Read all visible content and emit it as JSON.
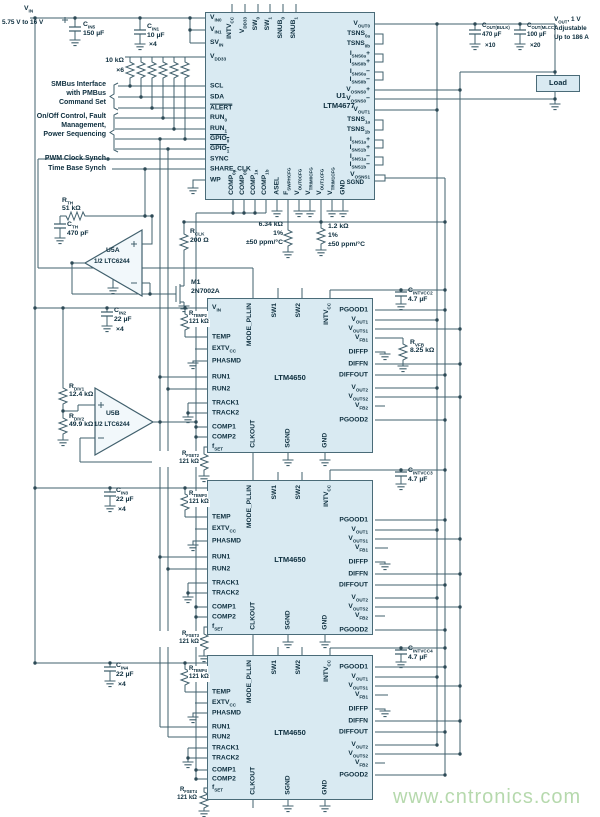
{
  "supply": {
    "vin": "V~IN~",
    "range": "5.75 V to 16 V"
  },
  "annotations": {
    "smbus1": "SMBus Interface",
    "smbus2": "with PMBus",
    "smbus3": "Command Set",
    "ctrl1": "On/Off Control, Fault",
    "ctrl2": "Management,",
    "ctrl3": "Power Sequencing",
    "pwm": "PWM Clock Synch",
    "timebase": "Time Base Synch"
  },
  "u1": {
    "ref": "U1",
    "part": "LTM4677",
    "left": [
      "V~IN0~",
      "V~IN1~",
      "SV~IN~",
      "V~DD33~",
      "SCL",
      "SDA",
      "^ALERT^",
      "RUN~0~",
      "RUN~1~",
      "^GPIO~0~^",
      "^GPIO~1~^",
      "SYNC",
      "SHARE_CLK",
      "WP"
    ],
    "right": [
      "V~OUT0~",
      "TSNS~0a~",
      "TSNS~0b~",
      "I~SNS0a~+",
      "I~SNS0b~+",
      "I~SNS0a~−",
      "I~SNS0b~−",
      "V~OSNS0~+",
      "V~OSNS0~−",
      "V~OUT1~",
      "TSNS~1a~",
      "TSNS~1b~",
      "I~SNS1a~+",
      "I~SNS1b~+",
      "I~SNS1a~−",
      "I~SNS1b~−",
      "V~OSNS1~",
      "SGND"
    ],
    "top": [
      "INTV~CC~",
      "V~DD33~",
      "SW~0~",
      "SW~1~",
      "SNUB~0~",
      "SNUB~1~"
    ],
    "bottom": [
      "COMP~0a~",
      "COMP~0b~",
      "COMP~1a~",
      "COMP~1b~",
      "ASEL",
      "F~SWPHCFG~",
      "V~OUT0CFG~",
      "V~TRIM0CFG~",
      "V~OUT1CFG~",
      "V~TRIM1CFG~",
      "GND"
    ]
  },
  "m4650": {
    "part": "LTM4650",
    "vin": "V~IN~",
    "left": [
      "TEMP",
      "EXTV~CC~",
      "PHASMD",
      "RUN1",
      "RUN2",
      "TRACK1",
      "TRACK2",
      "COMP1",
      "COMP2",
      "f~SET~"
    ],
    "right": [
      "PGOOD1",
      "V~OUT1~",
      "V~OUTS1~",
      "V~FB1~",
      "DIFFP",
      "DIFFN",
      "DIFFOUT",
      "V~OUT2~",
      "V~OUTS2~",
      "V~FB2~",
      "PGOOD2"
    ],
    "top": [
      "MODE_PLLIN",
      "SW1",
      "SW2",
      "INTV~CC~"
    ],
    "bottom": [
      "CLKOUT",
      "SGND",
      "GND"
    ]
  },
  "opamps": {
    "u5a": "U5A",
    "u5b": "U5B",
    "half": "1/2 LTC6244"
  },
  "m1": [
    "M1",
    "2N7002A"
  ],
  "components": {
    "cin5": [
      "C~IN5~",
      "150 µF"
    ],
    "cin1": [
      "C~IN1~",
      "10 µF",
      "×4"
    ],
    "rpull": [
      "10 kΩ",
      "×6"
    ],
    "rth": [
      "R~TH~",
      "51 kΩ"
    ],
    "cth": [
      "C~TH~",
      "470 pF"
    ],
    "rclk": [
      "R~CLK~",
      "200 Ω"
    ],
    "r634": [
      "6.34 kΩ",
      "1%",
      "±50 ppm/°C"
    ],
    "r12": [
      "1.2 kΩ",
      "1%",
      "±50 ppm/°C"
    ],
    "cin2": [
      "C~IN2~",
      "22 µF",
      "×4"
    ],
    "rtemp2": [
      "R~TEMP2~",
      "121 kΩ"
    ],
    "rtemp3": [
      "R~TEMP3~",
      "121 kΩ"
    ],
    "rtemp4": [
      "R~TEMP4~",
      "121 kΩ"
    ],
    "rfset2": [
      "R~FSET2~",
      "121 kΩ"
    ],
    "rfset3": [
      "R~FSET3~",
      "121 kΩ"
    ],
    "rfset4": [
      "R~FSET4~",
      "121 kΩ"
    ],
    "rdiv1": [
      "R~DIV1~",
      "12.4 kΩ"
    ],
    "rdiv2": [
      "R~DIV2~",
      "49.9 kΩ"
    ],
    "rvfb": [
      "R~VFB~",
      "8.25 kΩ"
    ],
    "cintvcc2": [
      "C~INTVCC2~",
      "4.7 µF"
    ],
    "cintvcc3": [
      "C~INTVCC3~",
      "4.7 µF"
    ],
    "cintvcc4": [
      "C~INTVCC4~",
      "4.7 µF"
    ],
    "cin3": [
      "C~IN3~",
      "22 µF",
      "×4"
    ],
    "cin4": [
      "C~IN4~",
      "22 µF",
      "×4"
    ],
    "coutb": [
      "C~OUT(BULK)~",
      "470 µF",
      "×10"
    ],
    "coutm": [
      "C~OUT(MLCC)~",
      "100 µF",
      "×20"
    ]
  },
  "output": {
    "line1": "V~OUT~, 1 V",
    "line2": "Adjustable",
    "line3": "Up to 186 A",
    "load": "Load"
  },
  "watermark": "www.cntronics.com"
}
